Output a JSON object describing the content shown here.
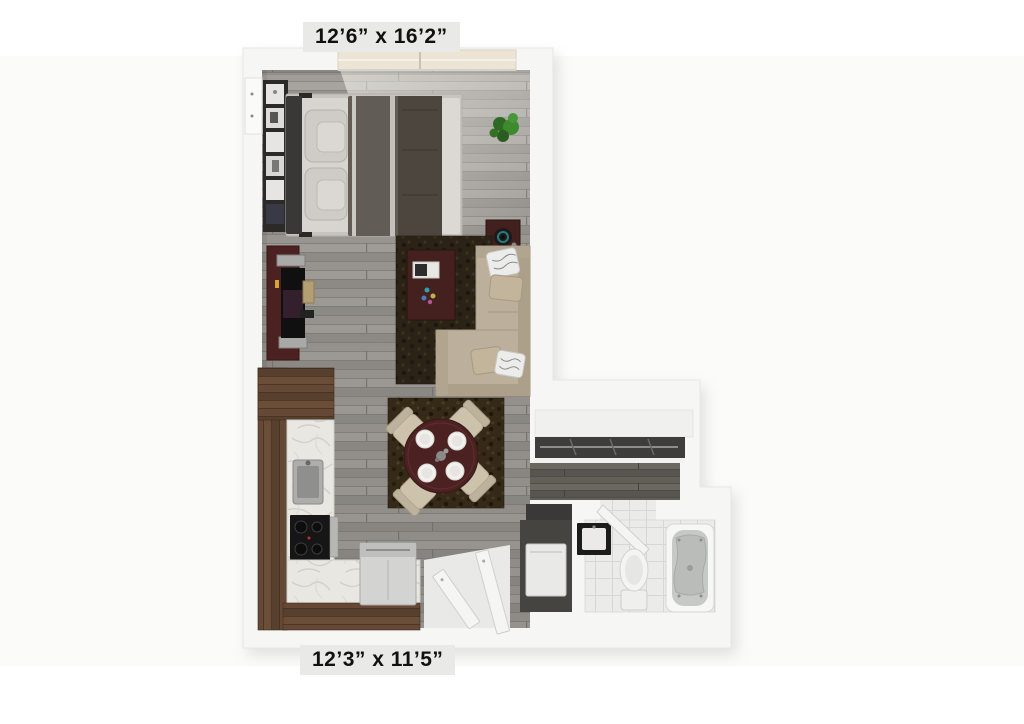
{
  "page": {
    "type": "3d-rendered-floor-plan",
    "background": "#ffffff"
  },
  "labels": {
    "top_dimension": "12’6” x 16’2”",
    "bottom_dimension": "12’3” x 11’5”"
  },
  "rooms": [
    {
      "name": "bedroom-living-area",
      "dimension_label": "12’6” x 16’2”",
      "furniture": [
        "bed",
        "bookshelf",
        "plant",
        "side-table-speaker",
        "tv-console",
        "tv",
        "sectional-sofa",
        "coffee-table",
        "area-rug",
        "window"
      ]
    },
    {
      "name": "kitchen-dining-area",
      "dimension_label": "12’3” x 11’5”",
      "furniture": [
        "dining-table",
        "dining-chairs",
        "dining-rug",
        "kitchen-counter",
        "sink",
        "cooktop",
        "refrigerator"
      ]
    },
    {
      "name": "closet",
      "furniture": [
        "closet-rod-shelf"
      ]
    },
    {
      "name": "entry",
      "furniture": [
        "entry-doors"
      ]
    },
    {
      "name": "utility-closet",
      "furniture": [
        "washer"
      ]
    },
    {
      "name": "bathroom",
      "furniture": [
        "vanity-sink",
        "toilet",
        "bathtub",
        "bathroom-door"
      ]
    }
  ],
  "colors": {
    "background": "#ffffff",
    "wall": "#f6f6f4",
    "wall_edge": "#e6e6e4",
    "floor_wood": "#9c9994",
    "hall_wood_dark": "#5d5b56",
    "kitchen_wood": "#5d4230",
    "counter_marble": "#e9e7e2",
    "accent_maroon": "#4c2122",
    "sofa_beige": "#bcb09c",
    "rug_brown": "#2b2316",
    "bed_duvet": "#615c55",
    "bathroom_tile": "#ebebe9",
    "plant_green": "#3f8a2f",
    "label_bg": "#e9e9e7",
    "label_text": "#111111"
  }
}
